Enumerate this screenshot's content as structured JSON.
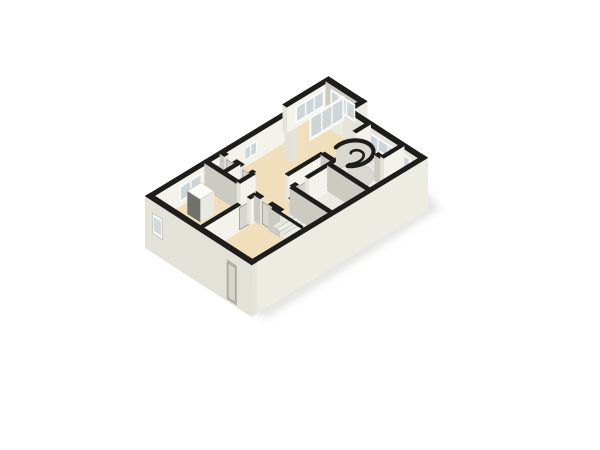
{
  "scene": {
    "label": "3D isometric floor plan render of a single-storey apartment",
    "canvas": {
      "w": 600,
      "h": 450,
      "bg": "#ffffff"
    },
    "projection": {
      "origin": [
        150,
        196
      ],
      "uAxis": [
        17.1,
        -10.4
      ],
      "vAxis": [
        14.57,
        9.43
      ],
      "floorDrop": 26,
      "groundDrop": 52
    },
    "palette": {
      "cap": "#1d1d1b",
      "faceBright": "#f3f3ec",
      "faceMid": "#e4e4db",
      "faceDark": "#cbcbc2",
      "faceDarker": "#c2c2b9",
      "facadeSW": "#e2e2d8",
      "facadeSE": "#ecece3",
      "facadeNE": "#e9e9e0",
      "floorBase": "#e9e9e1",
      "floorBeige": "#f1dfbc",
      "floorLight": "#ebebe3",
      "floorWhite": "#f1f2ed",
      "glass": "#ccd6d8",
      "frame": "#fbfbf9",
      "door": "#d7d7d0",
      "doorEdge": "#97978f",
      "tread": "#eff0e9",
      "treadAlt": "#e7e7df",
      "treadEdge": "#9f9f97",
      "rail": "#1d1d1b",
      "cylSide": "#d8d8d0",
      "white": "#fdfdfd",
      "fixtureEdge": "#c2c2bb",
      "shadow": "#c9c9c4",
      "recess": "#b3b3aa",
      "recessGlass": "#d3dadb",
      "wardrobeFront": "#72726c",
      "wardrobeSide": "#e9e9e2",
      "wardrobeTop": "#fbfbf8"
    },
    "shadow": {
      "pts": [
        [
          0.2,
          1.0
        ],
        [
          0.2,
          7.7
        ],
        [
          10.6,
          7.5
        ],
        [
          11.9,
          2.3
        ],
        [
          11.2,
          -0.3
        ],
        [
          10.2,
          0.3
        ]
      ],
      "opacity": 0.5,
      "blur": 4
    },
    "floors": [
      {
        "name": "slab-main",
        "rect": [
          0,
          0,
          10,
          7
        ],
        "color": "floorBase"
      },
      {
        "name": "slab-porch",
        "rect": [
          8.4,
          -0.45,
          10.8,
          0.9
        ],
        "color": "floorBase"
      },
      {
        "name": "bedroom-1",
        "rect": [
          0.12,
          0.12,
          3.3,
          3.4
        ],
        "color": "floorBeige"
      },
      {
        "name": "bedroom-2",
        "rect": [
          0.12,
          3.4,
          3.3,
          5.2
        ],
        "color": "floorBeige"
      },
      {
        "name": "entry-hall",
        "rect": [
          0.12,
          5.2,
          3.3,
          6.88
        ],
        "color": "floorBeige"
      },
      {
        "name": "hallway",
        "rect": [
          3.3,
          2.2,
          4.7,
          4.2
        ],
        "color": "floorBeige"
      },
      {
        "name": "hallway-spur",
        "rect": [
          4.7,
          3.4,
          7.2,
          4.2
        ],
        "color": "floorBeige"
      },
      {
        "name": "living-room",
        "rect": [
          4.2,
          0,
          10,
          3.4
        ],
        "color": "floorBeige"
      },
      {
        "name": "living-nook",
        "rect": [
          10,
          0.9,
          10.72,
          1.9
        ],
        "color": "floorBeige"
      },
      {
        "name": "porch-room",
        "rect": [
          8.4,
          -0.3,
          10.65,
          0.9
        ],
        "color": "floorBeige"
      },
      {
        "name": "closets",
        "rect": [
          3.3,
          0.12,
          4.2,
          2.2
        ],
        "color": "floorLight"
      },
      {
        "name": "stairwell",
        "rect": [
          3.3,
          4.2,
          4.7,
          6.88
        ],
        "color": "floorLight"
      },
      {
        "name": "room-br-1",
        "rect": [
          4.7,
          4.2,
          6.9,
          6.88
        ],
        "color": "floorLight"
      },
      {
        "name": "room-br-2",
        "rect": [
          6.9,
          4.2,
          8.8,
          6.88
        ],
        "color": "floorLight"
      },
      {
        "name": "bathroom",
        "rect": [
          8.8,
          3.3,
          10,
          5.6
        ],
        "color": "floorWhite"
      },
      {
        "name": "corner-room",
        "rect": [
          8.8,
          5.6,
          10,
          6.88
        ],
        "color": "floorLight"
      }
    ],
    "backWalls": [
      {
        "name": "wall-nw-main",
        "a": [
          -0.16,
          0
        ],
        "b": [
          8.4,
          0
        ],
        "t": 0.3
      },
      {
        "name": "wall-porch-w",
        "a": [
          8.4,
          -0.45
        ],
        "b": [
          8.4,
          0.05
        ],
        "t": 0.3,
        "dropB": 52,
        "colorB": "facadeSW"
      },
      {
        "name": "wall-porch-nw",
        "a": [
          8.26,
          -0.45
        ],
        "b": [
          10.95,
          -0.45
        ],
        "t": 0.3
      },
      {
        "name": "wall-porch-e",
        "a": [
          10.8,
          -0.45
        ],
        "b": [
          10.8,
          2.05
        ],
        "t": 0.3,
        "dropA": 52,
        "colorA": "facadeNE"
      },
      {
        "name": "wall-jog",
        "a": [
          10.96,
          1.9
        ],
        "b": [
          9.84,
          1.9
        ],
        "t": 0.3,
        "dropA": 52,
        "colorA": "facadeSE"
      },
      {
        "name": "wall-ne-main",
        "a": [
          10,
          1.78
        ],
        "b": [
          10,
          7
        ],
        "t": 0.3,
        "dropA": 52,
        "colorA": "facadeNE",
        "colorB": "faceMid"
      }
    ],
    "backWindows": [
      {
        "name": "window-bedroom-nw",
        "p1": [
          1.6,
          0.16
        ],
        "p2": [
          2.9,
          0.16
        ],
        "z1": 5,
        "z2": 22,
        "panes": 2
      },
      {
        "name": "window-closet-nw",
        "p1": [
          3.5,
          0.16
        ],
        "p2": [
          4.05,
          0.16
        ],
        "z1": 6,
        "z2": 20,
        "panes": 1
      },
      {
        "name": "window-hall-nw",
        "p1": [
          5.4,
          0.16
        ],
        "p2": [
          6.1,
          0.16
        ],
        "z1": 6,
        "z2": 20,
        "panes": 2
      },
      {
        "name": "window-porch-nw",
        "p1": [
          8.75,
          -0.29
        ],
        "p2": [
          10.45,
          -0.29
        ],
        "z1": 4,
        "z2": 22,
        "panes": 3
      },
      {
        "name": "window-porch-ne",
        "p1": [
          10.64,
          -0.1
        ],
        "p2": [
          10.64,
          1.6
        ],
        "z1": 4,
        "z2": 22,
        "panes": 3
      },
      {
        "name": "window-ne-band",
        "p1": [
          9.84,
          3.2
        ],
        "p2": [
          9.84,
          6.4
        ],
        "z1": 5,
        "z2": 22,
        "panes": 4
      }
    ],
    "glassWall": {
      "name": "sliding-glass-door",
      "p1": [
        8.55,
        0.9
      ],
      "p2": [
        10.6,
        0.9
      ],
      "z1": 1,
      "z2": 26,
      "panes": 3,
      "opacity": 0.92
    },
    "middle": [
      {
        "type": "wall",
        "name": "iw2a",
        "a": [
          4.2,
          0
        ],
        "b": [
          4.2,
          0.32
        ],
        "t": 0.24
      },
      {
        "type": "wall",
        "name": "iw2b",
        "a": [
          4.2,
          0.88
        ],
        "b": [
          4.2,
          1.42
        ],
        "t": 0.24
      },
      {
        "type": "wall",
        "name": "iw2c",
        "a": [
          4.2,
          1.98
        ],
        "b": [
          4.2,
          2.2
        ],
        "t": 0.24
      },
      {
        "type": "door",
        "name": "door-closet-1",
        "p1": [
          4.2,
          0.34
        ],
        "p2": [
          4.2,
          0.86
        ]
      },
      {
        "type": "door",
        "name": "door-closet-2",
        "p1": [
          4.2,
          1.44
        ],
        "p2": [
          4.2,
          1.96
        ]
      },
      {
        "type": "wall",
        "name": "iw3",
        "a": [
          3.3,
          1.15
        ],
        "b": [
          4.2,
          1.15
        ],
        "t": 0.24
      },
      {
        "type": "wall",
        "name": "iw1a",
        "a": [
          3.3,
          0
        ],
        "b": [
          3.3,
          2.5
        ],
        "t": 0.24
      },
      {
        "type": "door",
        "name": "door-bedroom-1",
        "p1": [
          3.3,
          2.52
        ],
        "p2": [
          3.3,
          3.04
        ]
      },
      {
        "type": "wall",
        "name": "iw1b",
        "a": [
          3.3,
          3.06
        ],
        "b": [
          3.3,
          3.4
        ],
        "t": 0.24
      },
      {
        "type": "wardrobe",
        "name": "wardrobe",
        "rect": [
          1.5,
          0.8,
          2.3,
          1.7
        ],
        "topZ": 3
      },
      {
        "type": "wall",
        "name": "iw4",
        "a": [
          3.3,
          2.2
        ],
        "b": [
          4.2,
          2.2
        ],
        "t": 0.24
      },
      {
        "type": "wall",
        "name": "iw5a",
        "a": [
          0,
          3.4
        ],
        "b": [
          2.32,
          3.4
        ],
        "t": 0.24
      },
      {
        "type": "door",
        "name": "door-bedroom-2",
        "p1": [
          2.34,
          3.4
        ],
        "p2": [
          2.86,
          3.4
        ]
      },
      {
        "type": "wall",
        "name": "iw5b",
        "a": [
          2.88,
          3.4
        ],
        "b": [
          3.3,
          3.4
        ],
        "t": 0.24
      },
      {
        "type": "wall",
        "name": "iw8",
        "a": [
          5.1,
          3.4
        ],
        "b": [
          7.2,
          3.4
        ],
        "t": 0.24
      },
      {
        "type": "wall",
        "name": "iw8b",
        "a": [
          7.2,
          3.4
        ],
        "b": [
          7.2,
          4.2
        ],
        "t": 0.24
      },
      {
        "type": "wall",
        "name": "iw18",
        "a": [
          9.15,
          3.3
        ],
        "b": [
          10,
          3.3
        ],
        "t": 0.24
      },
      {
        "type": "wall",
        "name": "iw14a",
        "a": [
          4.7,
          4.2
        ],
        "b": [
          5.02,
          4.2
        ],
        "t": 0.24
      },
      {
        "type": "door",
        "name": "door-room-1",
        "p1": [
          5.04,
          4.2
        ],
        "p2": [
          5.56,
          4.2
        ]
      },
      {
        "type": "wall",
        "name": "iw14b",
        "a": [
          5.58,
          4.2
        ],
        "b": [
          7.52,
          4.2
        ],
        "t": 0.24
      },
      {
        "type": "door",
        "name": "door-room-2",
        "p1": [
          7.54,
          4.2
        ],
        "p2": [
          8.06,
          4.2
        ]
      },
      {
        "type": "wall",
        "name": "iw14c",
        "a": [
          8.08,
          4.2
        ],
        "b": [
          8.8,
          4.2
        ],
        "t": 0.24
      },
      {
        "type": "spiral",
        "name": "spiral-staircase",
        "c": [
          8.2,
          4.3
        ],
        "r": 0.92,
        "wallFrom": 255,
        "wallTo": 505,
        "swirl": {
          "aFrom": 505,
          "aTo": 265,
          "rFrom": 0.72,
          "rTo": 0.13
        },
        "radials": [
          270,
          310,
          350,
          30,
          70
        ]
      },
      {
        "type": "toilet",
        "name": "toilet",
        "tank": [
          9.56,
          4.38,
          9.74,
          4.9
        ],
        "tankTopZ": 14,
        "bowl": [
          9.36,
          4.64
        ],
        "bowlZ": 21,
        "rx": 6,
        "ry": 4.2
      },
      {
        "type": "wall",
        "name": "iw6a",
        "a": [
          3.3,
          3.4
        ],
        "b": [
          3.3,
          3.82
        ],
        "t": 0.24
      },
      {
        "type": "door",
        "name": "door-bedroom-2b",
        "p1": [
          3.3,
          3.84
        ],
        "p2": [
          3.3,
          4.36
        ]
      },
      {
        "type": "wall",
        "name": "iw6b",
        "a": [
          3.3,
          4.38
        ],
        "b": [
          3.3,
          5.2
        ],
        "t": 0.24
      },
      {
        "type": "wall",
        "name": "iw15",
        "a": [
          6.9,
          4.2
        ],
        "b": [
          6.9,
          7
        ],
        "t": 0.24
      },
      {
        "type": "wall",
        "name": "iw16",
        "a": [
          8.8,
          5.2
        ],
        "b": [
          8.8,
          7
        ],
        "t": 0.24
      },
      {
        "type": "wall",
        "name": "iw17",
        "a": [
          8.8,
          5.6
        ],
        "b": [
          10,
          5.6
        ],
        "t": 0.24
      },
      {
        "type": "stairs",
        "name": "straight-staircase",
        "u1": 3.52,
        "u2": 4.56,
        "vTop": 4.3,
        "treads": 8,
        "dv": 0.28,
        "fan": [
          [
            [
              3.52,
              6.54
            ],
            [
              4.56,
              6.54
            ],
            [
              4.56,
              6.9
            ],
            [
              3.52,
              6.9
            ]
          ],
          [
            [
              3.52,
              6.9
            ],
            [
              4.56,
              6.9
            ],
            [
              4.0,
              6.97
            ],
            [
              3.52,
              6.95
            ]
          ]
        ],
        "railR": [
          [
            4.5,
            4.35
          ],
          [
            4.5,
            5.85
          ],
          [
            4.38,
            6.4
          ],
          [
            4.0,
            6.75
          ],
          [
            3.5,
            6.88
          ],
          [
            3.05,
            6.8
          ]
        ],
        "railL": [
          [
            3.5,
            4.35
          ],
          [
            3.5,
            6.3
          ]
        ],
        "railZ": 8
      },
      {
        "type": "wall",
        "name": "iw7",
        "a": [
          4.7,
          4.2
        ],
        "b": [
          4.7,
          7
        ],
        "t": 0.24
      }
    ],
    "frontWalls": [
      {
        "name": "wall-se-facade",
        "a": [
          0,
          7
        ],
        "b": [
          10.16,
          7
        ],
        "t": 0.3,
        "dropA": 26,
        "dropB": 52,
        "colorA": "faceDark",
        "colorB": "facadeSE"
      },
      {
        "name": "wall-sw-facade",
        "a": [
          0,
          -0.16
        ],
        "b": [
          0,
          7.16
        ],
        "t": 0.3,
        "dropA": 26,
        "dropB": 52,
        "colorA": "faceDark",
        "colorB": "facadeSW"
      }
    ],
    "facadeFeatures": [
      {
        "type": "window",
        "name": "facade-window-sw",
        "p1": [
          -0.16,
          0.35
        ],
        "p2": [
          -0.16,
          1.05
        ],
        "z1": 12,
        "z2": 32
      },
      {
        "type": "door",
        "name": "front-door",
        "p1": [
          -0.16,
          5.45
        ],
        "p2": [
          -0.16,
          6.15
        ],
        "z1": 10,
        "z2": 50
      }
    ]
  }
}
